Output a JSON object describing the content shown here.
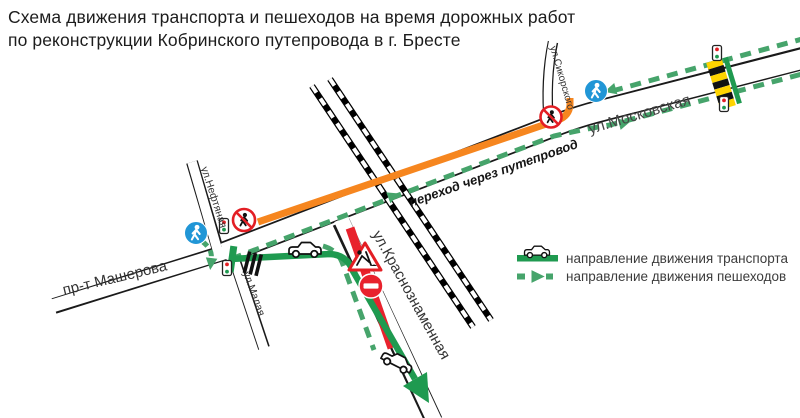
{
  "title": {
    "line1": "Схема движения транспорта и пешеходов на время дорожных работ",
    "line2": "по реконструкции Кобринского путепровода в г. Бресте"
  },
  "map": {
    "streets": {
      "moskovskaya": "ул.Московская",
      "masherova": "пр-т Машерова",
      "krasnoznamennaya": "ул.Краснознаменная",
      "neftyanaya": "ул.Нефтяная",
      "malaya": "ул.Малая",
      "sikorskogo": "ул.Сикорского"
    },
    "overpass_label": "переход через путепровод",
    "icons": [
      "pedestrian-path-sign",
      "no-pedestrians-sign",
      "no-entry-sign",
      "roadworks-sign",
      "traffic-light",
      "car",
      "crosswalk",
      "railway"
    ]
  },
  "legend": {
    "items": [
      {
        "label": "направление движения транспорта"
      },
      {
        "label": "направление движения пешеходов"
      }
    ]
  },
  "colors": {
    "transport_green": "#1f9a50",
    "pedestrian_green": "#46a46b",
    "closed_section_orange": "#f6861f",
    "closed_section_red": "#e8222d",
    "sign_blue": "#2196d6",
    "sign_red": "#e31e24",
    "zebra_yellow": "#ffd400"
  }
}
